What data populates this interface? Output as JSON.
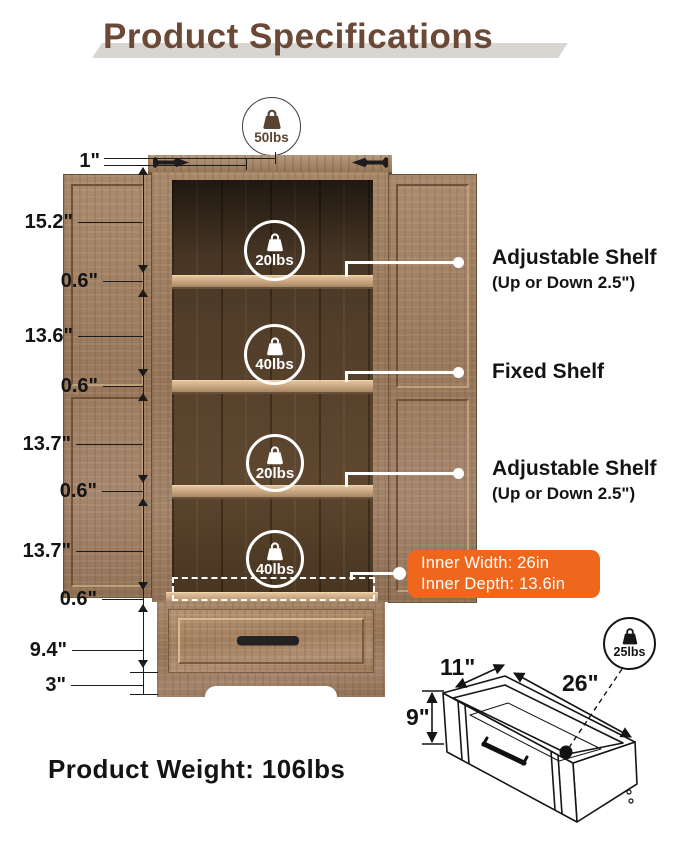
{
  "title": "Product Specifications",
  "capacities": {
    "top": "50lbs",
    "shelf_1": "20lbs",
    "shelf_2": "40lbs",
    "shelf_3": "20lbs",
    "shelf_4": "40lbs",
    "drawer": "25lbs"
  },
  "dimensions_left": [
    "1\"",
    "15.2\"",
    "0.6\"",
    "13.6\"",
    "0.6\"",
    "13.7\"",
    "0.6\"",
    "13.7\"",
    "0.6\"",
    "9.4\"",
    "3\""
  ],
  "shelf_callouts": [
    {
      "title": "Adjustable Shelf",
      "subtitle": "(Up or Down 2.5\")"
    },
    {
      "title": "Fixed Shelf"
    },
    {
      "title": "Adjustable Shelf",
      "subtitle": "(Up or Down 2.5\")"
    }
  ],
  "inner_size_badge": {
    "line1": "Inner Width: 26in",
    "line2": "Inner Depth: 13.6in"
  },
  "drawer_dimensions": {
    "depth": "11\"",
    "width": "26\"",
    "height": "9\""
  },
  "product_weight": "Product Weight: 106lbs",
  "colors": {
    "accent_orange": "#ee671c",
    "title_brown": "#6b4936",
    "callout_white": "#ffffff"
  }
}
